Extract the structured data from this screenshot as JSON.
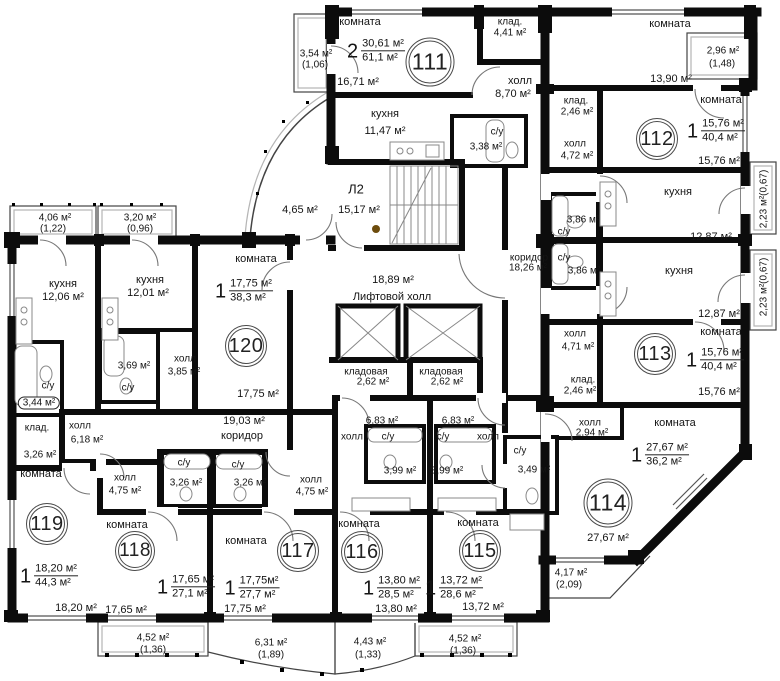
{
  "common": {
    "stair_label": "Л2",
    "stair_area": "15,17 м²",
    "vestibule_area": "4,65 м²",
    "lifthall_area": "18,89 м²",
    "lifthall_label": "Лифтовой холл",
    "corridor_right_label": "коридор",
    "corridor_right_area": "18,26 м²",
    "corridor_left_area": "19,03 м²",
    "corridor_left_label": "коридор",
    "storeroom1_label": "кладовая",
    "storeroom1_area": "2,62 м²",
    "storeroom2_label": "кладовая",
    "storeroom2_area": "2,62 м²"
  },
  "a111": {
    "num": "111",
    "rooms": "2",
    "living": "30,61 м²",
    "total": "61,1 м²",
    "room_label": "комната",
    "room_area": "16,71 м²",
    "kitchen_label": "кухня",
    "kitchen_area": "11,47 м²",
    "pantry_label": "клад.",
    "pantry_area": "4,41 м²",
    "hall_label": "холл",
    "hall_area": "8,70 м²",
    "wc_label": "с/у",
    "wc_area": "3,38 м²",
    "balc": "3,54 м²",
    "balc_k": "(1,06)"
  },
  "a112": {
    "num": "112",
    "rooms": "1",
    "living": "15,76 м²",
    "total": "40,4 м²",
    "room1_label": "комната",
    "room1_area": "13,90 м²",
    "room2_label": "комната",
    "room2_area": "15,76 м²",
    "pantry_label": "клад.",
    "pantry_area": "2,46 м²",
    "hall_label": "холл",
    "hall_area": "4,72 м²",
    "kitchen_label": "кухня",
    "kitchen_area": "12,87 м²",
    "wc_label": "с/у",
    "wc_area": "3,86 м²",
    "balc_top": "2,96 м²",
    "balc_top_k": "(1,48)",
    "balc_side": "2,23 м²(0,67)"
  },
  "a113": {
    "num": "113",
    "rooms": "1",
    "living": "15,76 м²",
    "total": "40,4 м²",
    "room_label": "комната",
    "room_area": "15,76 м²",
    "kitchen_label": "кухня",
    "kitchen_area": "12,87 м²",
    "hall_label": "холл",
    "hall_area": "4,71 м²",
    "pantry_label": "клад.",
    "pantry_area": "2,46 м²",
    "wc_label": "с/у",
    "wc_area": "3,86 м²",
    "balc_side": "2,23 м²(0,67)"
  },
  "a114": {
    "num": "114",
    "rooms": "1",
    "living": "27,67 м²",
    "total": "36,2 м²",
    "room_label": "комната",
    "room_area": "27,67 м²",
    "hall_label": "холл",
    "hall_area": "2,94 м²",
    "wc_label": "с/у",
    "wc_area": "3,49 м²",
    "balc": "4,17 м²",
    "balc_k": "(2,09)"
  },
  "a115": {
    "num": "115",
    "rooms": "1",
    "living": "13,72 м²",
    "total": "28,6 м²",
    "room_label": "комната",
    "room_area": "13,72 м²",
    "hall_label": "холл",
    "hall_area": "6,83 м²",
    "wc_label": "с/у",
    "wc_area": "3,99 м²",
    "balc": "4,52 м²",
    "balc_k": "(1,36)"
  },
  "a116": {
    "num": "116",
    "rooms": "1",
    "living": "13,80 м²",
    "total": "28,5 м²",
    "room_label": "комната",
    "room_area": "13,80 м²",
    "hall_label": "холл",
    "hall_area": "6,83 м²",
    "wc_label": "с/у",
    "wc_area": "3,99 м²",
    "balc": "4,43 м²",
    "balc_k": "(1,33)"
  },
  "a117": {
    "num": "117",
    "rooms": "1",
    "living": "17,75м²",
    "total": "27,7 м²",
    "room_label": "комната",
    "room_area": "17,75 м²",
    "hall_label": "холл",
    "hall_area": "4,75 м²",
    "wc_label": "с/у",
    "wc_area": "3,26 м²",
    "balc": "6,31 м²",
    "balc_k": "(1,89)"
  },
  "a118": {
    "num": "118",
    "rooms": "1",
    "living": "17,65 м²",
    "total": "27,1 м²",
    "room_label": "комната",
    "room_area": "17,65 м²",
    "hall_label": "холл",
    "hall_area": "4,75 м²",
    "wc_label": "с/у",
    "wc_area": "3,26 м²",
    "balc": "4,52 м²",
    "balc_k": "(1,36)"
  },
  "a119": {
    "num": "119",
    "rooms": "1",
    "living": "18,20 м²",
    "total": "44,3 м²",
    "room_label": "комната",
    "room_area": "18,20 м²",
    "kitchen_label": "кухня",
    "kitchen_area": "12,06 м²",
    "wc_label": "с/у",
    "wc_area": "3,44 м²",
    "pantry_label": "клад.",
    "pantry_area": "3,26 м²",
    "hall_label": "холл",
    "hall_area": "6,18 м²",
    "balc": "4,06 м²",
    "balc_k": "(1,22)"
  },
  "a120": {
    "num": "120",
    "rooms": "1",
    "living": "17,75 м²",
    "total": "38,3 м²",
    "room_label": "комната",
    "room_area": "17,75 м²",
    "kitchen_label": "кухня",
    "kitchen_area": "12,01 м²",
    "wc_label": "с/у",
    "wc_area": "3,69 м²",
    "hall_label": "холл",
    "hall_area": "3,85 м²",
    "balc": "3,20 м²",
    "balc_k": "(0,96)"
  }
}
